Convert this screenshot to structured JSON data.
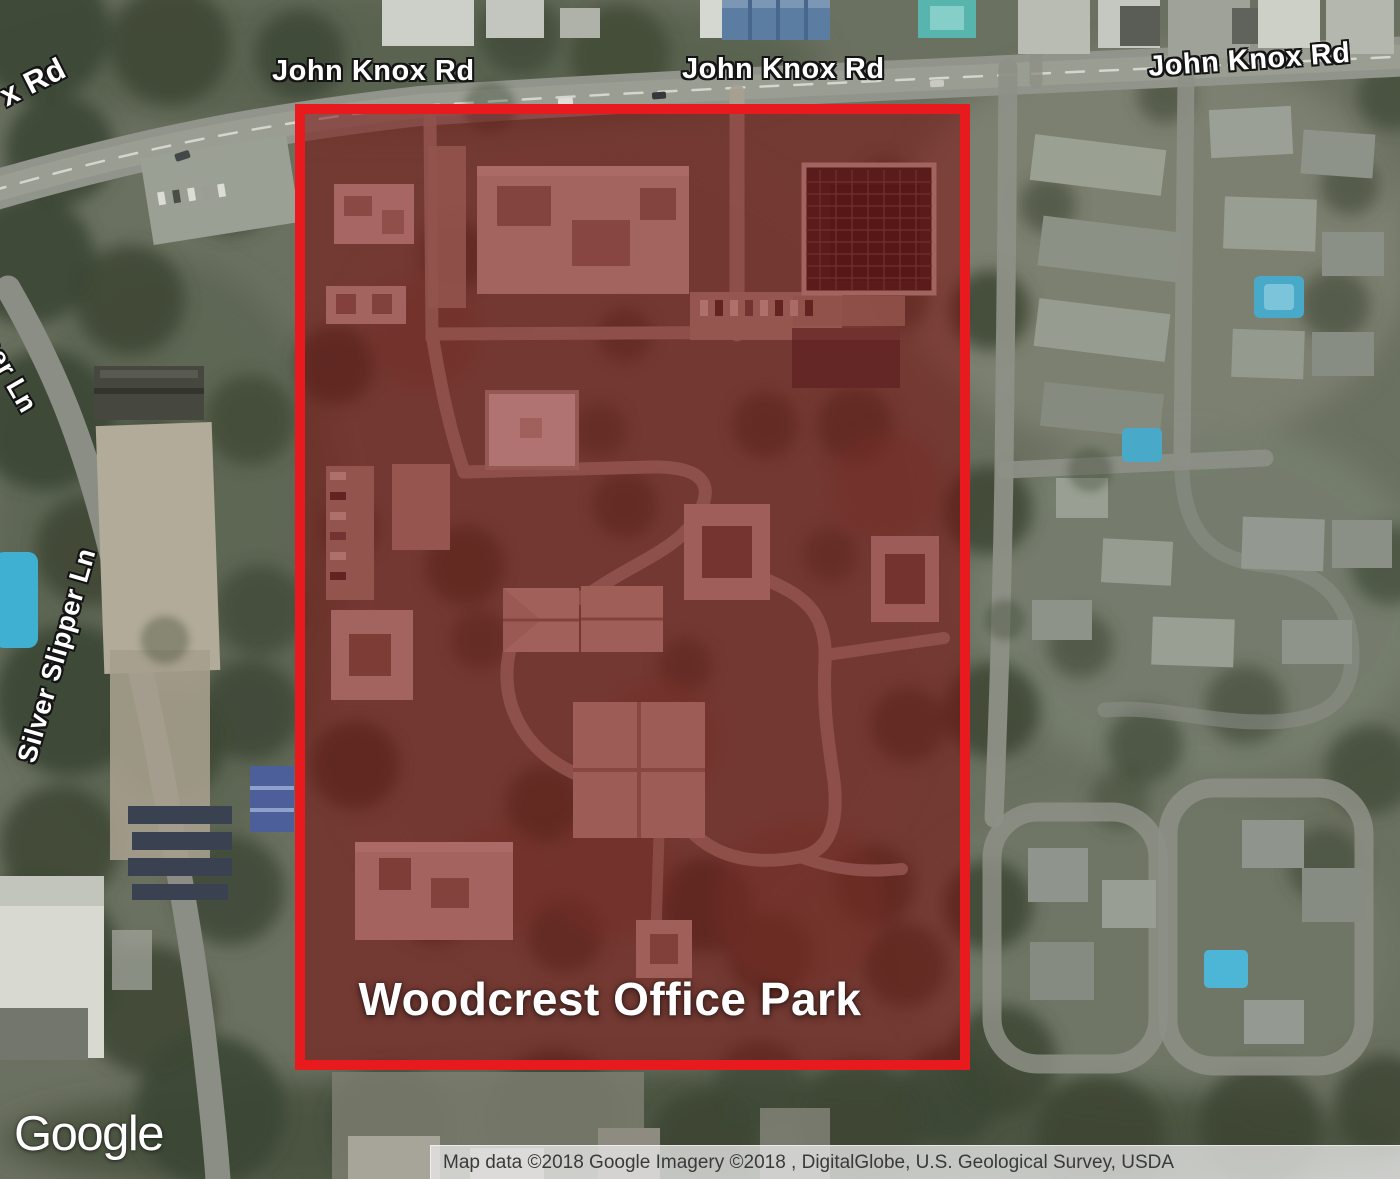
{
  "map": {
    "labels": {
      "x_rd_partial": "x Rd",
      "john_knox_1": "John Knox Rd",
      "john_knox_2": "John Knox Rd",
      "john_knox_3": "John Knox Rd",
      "slipper_partial": "pper Ln",
      "silver_slipper": "Silver Slipper Ln"
    },
    "overlay": {
      "label": "Woodcrest Office Park",
      "border_color": "#e81a1d",
      "fill_color": "rgba(122,8,10,0.52)"
    },
    "branding": {
      "logo_text": "Google"
    },
    "attribution": {
      "text": "Map data ©2018 Google Imagery ©2018 , DigitalGlobe, U.S. Geological Survey, USDA"
    }
  }
}
